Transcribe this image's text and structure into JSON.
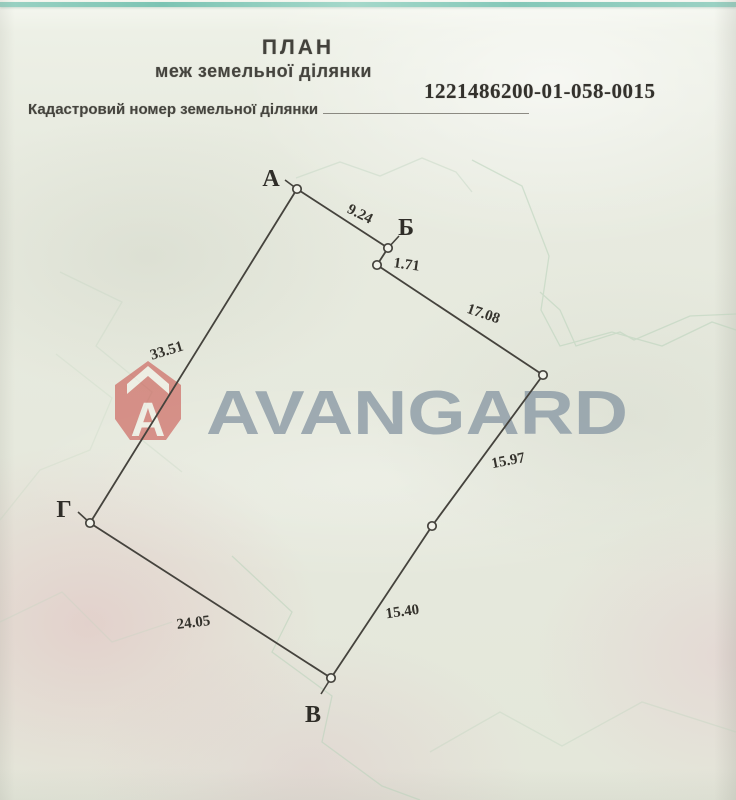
{
  "document": {
    "title": "ПЛАН",
    "subtitle": "меж земельної ділянки",
    "cadastral_number": "1221486200-01-058-0015",
    "cadastral_label": "Кадастровий номер земельної ділянки"
  },
  "watermark": {
    "brand": "AVANGARD",
    "logo_letter": "A",
    "brand_color": "#8b9aa5",
    "logo_color": "#c64540"
  },
  "scan": {
    "strip_color": "#7cc4b3",
    "paper_color": "#e8ebe0"
  },
  "plan": {
    "stroke_color": "#45433d",
    "vertices": [
      {
        "name": "А",
        "x": 297,
        "y": 189,
        "label_x": 271,
        "label_y": 186
      },
      {
        "name": "Б",
        "x": 388,
        "y": 248,
        "label_x": 406,
        "label_y": 235
      },
      {
        "name": "",
        "x": 377,
        "y": 265
      },
      {
        "name": "",
        "x": 543,
        "y": 375
      },
      {
        "name": "",
        "x": 432,
        "y": 526
      },
      {
        "name": "В",
        "x": 331,
        "y": 678,
        "label_x": 313,
        "label_y": 722
      },
      {
        "name": "Г",
        "x": 90,
        "y": 523,
        "label_x": 64,
        "label_y": 517
      }
    ],
    "segments": [
      {
        "label": "9.24",
        "x": 358,
        "y": 218,
        "rot": 27
      },
      {
        "label": "1.71",
        "x": 406,
        "y": 269,
        "rot": 8
      },
      {
        "label": "17.08",
        "x": 482,
        "y": 318,
        "rot": 19
      },
      {
        "label": "15.97",
        "x": 509,
        "y": 465,
        "rot": -11
      },
      {
        "label": "15.40",
        "x": 403,
        "y": 616,
        "rot": -8
      },
      {
        "label": "24.05",
        "x": 194,
        "y": 627,
        "rot": -7
      },
      {
        "label": "33.51",
        "x": 168,
        "y": 355,
        "rot": -17
      }
    ],
    "ticks": [
      {
        "x1": 297,
        "y1": 189,
        "x2": 285,
        "y2": 180
      },
      {
        "x1": 388,
        "y1": 248,
        "x2": 399,
        "y2": 236
      },
      {
        "x1": 331,
        "y1": 678,
        "x2": 321,
        "y2": 694
      },
      {
        "x1": 90,
        "y1": 523,
        "x2": 78,
        "y2": 512
      }
    ]
  }
}
